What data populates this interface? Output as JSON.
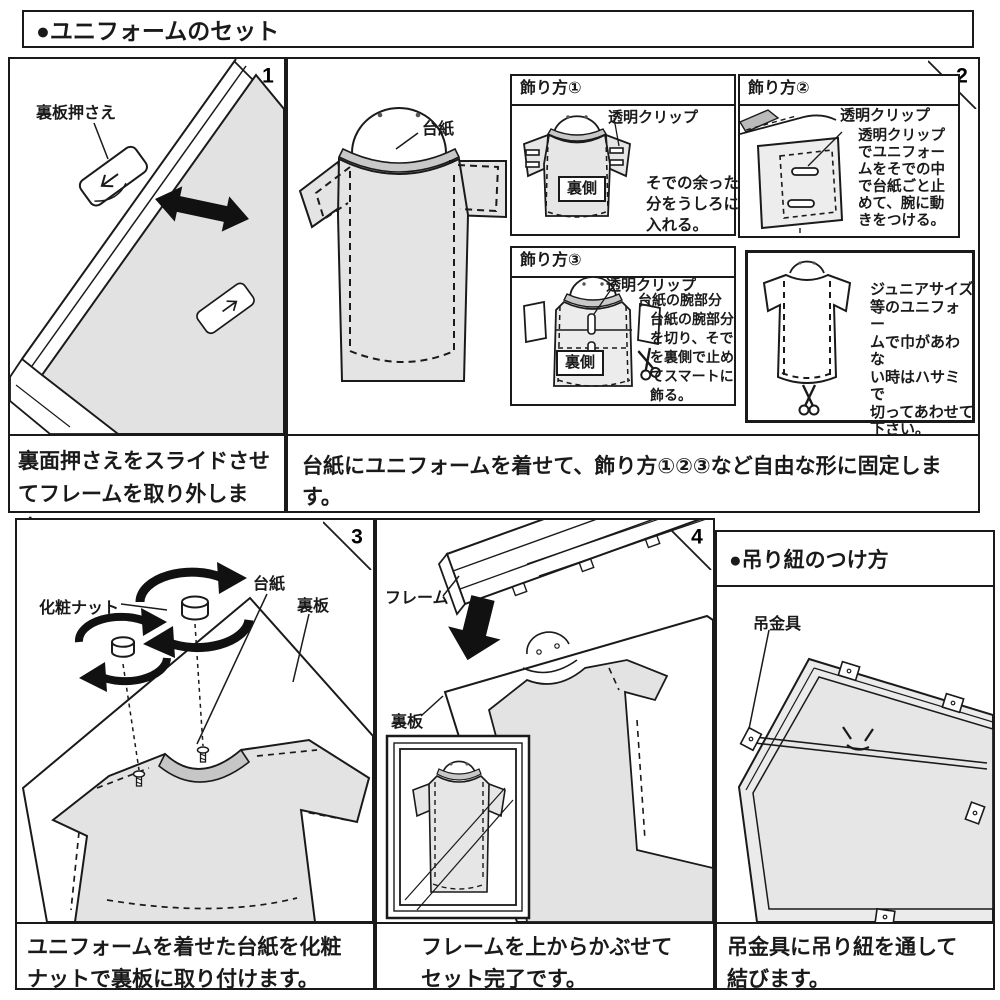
{
  "titles": {
    "main": "●ユニフォームのセット"
  },
  "step1": {
    "number": "1",
    "label_holder": "裏板押さえ",
    "caption": [
      "裏面押さえをスライドさせ",
      "てフレームを取り外します。"
    ]
  },
  "step2": {
    "number": "2",
    "label_cardboard": "台紙",
    "caption": "台紙にユニフォームを着せて、飾り方①②③など自由な形に固定します。",
    "deco1": {
      "title": "飾り方①",
      "label_clip": "透明クリップ",
      "label_back": "裏側",
      "note": [
        "そでの余った",
        "分をうしろに",
        "入れる。"
      ]
    },
    "deco2": {
      "title": "飾り方②",
      "label_clip": "透明クリップ",
      "note": [
        "透明クリップ",
        "でユニフォー",
        "ムをそでの中",
        "で台紙ごと止",
        "めて、腕に動",
        "きをつける。"
      ]
    },
    "deco3": {
      "title": "飾り方③",
      "label_clip": "透明クリップ",
      "label_arm": "台紙の腕部分",
      "label_back": "裏側",
      "note": [
        "台紙の腕部分",
        "を切り、そで",
        "を裏側で止め",
        "てスマートに",
        "飾る。"
      ]
    },
    "junior": {
      "note": [
        "ジュニアサイズ",
        "等のユニフォー",
        "ムで巾があわな",
        "い時はハサミで",
        "切ってあわせて",
        "下さい。"
      ]
    }
  },
  "step3": {
    "number": "3",
    "label_nut": "化粧ナット",
    "label_cardboard": "台紙",
    "label_backboard": "裏板",
    "caption": [
      "ユニフォームを着せた台紙を化粧",
      "ナットで裏板に取り付けます。"
    ]
  },
  "step4": {
    "number": "4",
    "label_frame": "フレーム",
    "label_backboard": "裏板",
    "caption": [
      "フレームを上からかぶせて",
      "セット完了です。"
    ]
  },
  "hanging": {
    "title": "●吊り紐のつけ方",
    "label_hook": "吊金具",
    "caption": [
      "吊金具に吊り紐を通して",
      "結びます。"
    ]
  }
}
